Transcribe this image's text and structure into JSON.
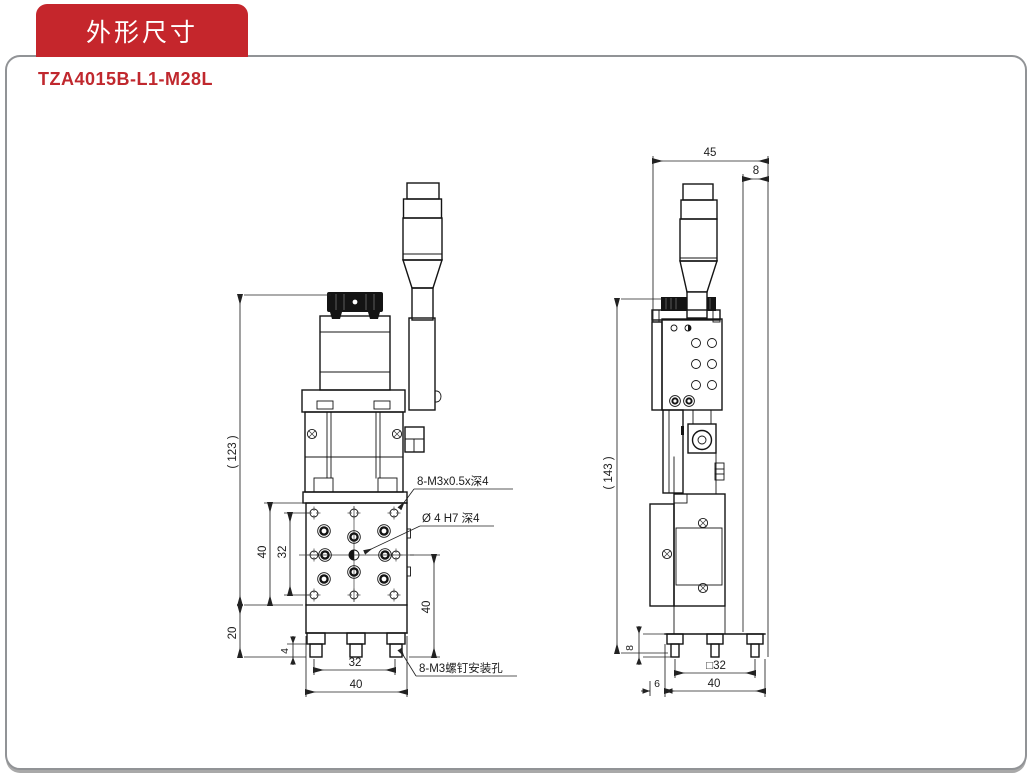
{
  "header": {
    "tab_label": "外形尺寸",
    "model": "TZA4015B-L1-M28L"
  },
  "colors": {
    "accent_red": "#c5262c",
    "panel_border": "#919396",
    "drawing_line": "#141414"
  },
  "front_view": {
    "dims": {
      "overall": "( 123 )",
      "base_h": "20",
      "plate_h": "40",
      "holes_v": "32",
      "foot_h": "4",
      "holes_h": "32",
      "width": "40",
      "right_h": "40"
    },
    "notes": {
      "tap": "8-M3x0.5x深4",
      "pin": "Ø 4 H7 深4",
      "mount": "8-M3螺钉安装孔"
    }
  },
  "side_view": {
    "dims": {
      "width": "45",
      "top_offset": "8",
      "overall": "( 143 )",
      "foot_h": "8",
      "square": "□32",
      "base_w": "40",
      "edge_offset": "6"
    }
  }
}
